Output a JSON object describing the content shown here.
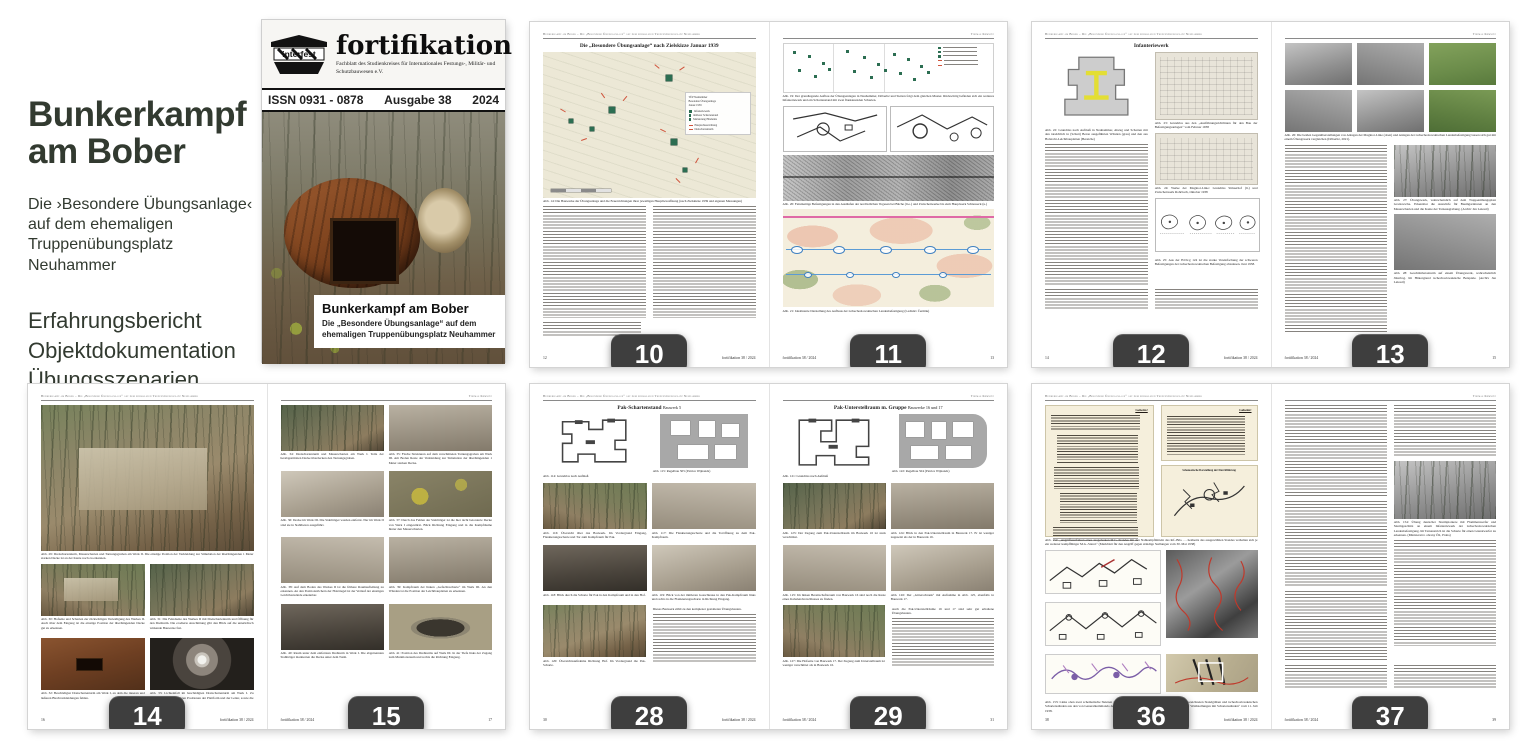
{
  "colors": {
    "badge_bg": "#3e3e3e",
    "badge_text": "#ffffff",
    "sidebar_text": "#323a30",
    "map_green": "#2c6e52",
    "map_red": "#d0543c"
  },
  "sidebar": {
    "title_line1": "Bunkerkampf",
    "title_line2": "am Bober",
    "subtitle": "Die ›Besondere Übungsanlage‹ auf dem ehemaligen Truppenübungsplatz Neuhammer",
    "features": [
      "Erfahrungsbericht",
      "Objektdokumentation",
      "Übungsszenarien"
    ],
    "link": "vimudeap.info/bkab"
  },
  "cover": {
    "logo_text": "interfest",
    "magazine_title": "fortifikation",
    "magazine_subtitle": "Fachblatt des Studienkreises für Internationales Festungs-, Militär- und Schutzbauwesen e.V.",
    "issn": "ISSN 0931 - 0878",
    "issue": "Ausgabe 38",
    "year": "2024",
    "cover_title": "Bunkerkampf am Bober",
    "cover_subtitle": "Die „Besondere Übungsanlage“ auf dem ehemaligen Truppen­übungsplatz Neuhammer"
  },
  "common": {
    "running_header": "Bunkerkampf am Bober – Die „Besondere Übungsanlage“ auf dem ehemaligen Truppenübungsplatz Neuhammer",
    "author": "Thomas Kemnitz",
    "journal_footer": "fortifikation 38 / 2024"
  },
  "pages": {
    "p10": {
      "badge": "10",
      "folio": "12",
      "title": "Die „Besondere Übungsanlage“ nach Zielskizze Januar 1939",
      "map_legend": {
        "line1": "TÜP Neuhammer",
        "line2": "Besondere Übungsanlage",
        "line3": "Januar 1939",
        "items": [
          "Infanteriewerk",
          "mittlerer Schartenstand",
          "Markierung Hindernis"
        ],
        "items_red": [
          "Hauptschussrichtung",
          "Dreischartenturm"
        ]
      },
      "captions": [
        "Abb. 14: Die Bauwerke der Übungsanlage und die Feuerrichtungen ihrer jeweiligen Hauptbewaffnung (nach Zielskizze 1939 und eigenen Messungen)"
      ]
    },
    "p11": {
      "badge": "11",
      "folio": "13",
      "captions": [
        "Abb. 19: Der grundlegende Aufbau der Übungsanlagen in Neuhammer, Döberitz und Stetten folgt dem gleichen Muster. Rückwärtig befinden sich ein weiteres Infanteriewerk und ein Schartenstand mit zwei flankierenden Scharten.",
        "Abb. 20: Feindseitige Befestigungen in den Ausläufen der nordöstlichen Vogesen bei Bitche (li.o.) und Zwischenwerke bis zum Hauptwerk Schiesseck (u.)",
        "Abb. 21: Idealisierte Darstellung des Aufbaus der tschechoslowakischen Landesbefestigung (Ladislav Čermák)"
      ]
    },
    "p12": {
      "badge": "12",
      "folio": "14",
      "heading": "Infanteriewerk",
      "captions": [
        "Abb. 22: Grundriss nach Aufmaß in Neuhammer, Abzug und Scharten mit den tatsächlich in (Schutt) Beton ausgeführten Wänden (grau) und den aus Holzrohr-Leichtbauplatten (Bereiche)",
        "Abb. 23: Grundriss aus den „Ausführungsrichtlinien für den Bau der Befestigungsanlagen“ vom Februar 1938",
        "Abb. 24: Werke der Maginot-Linie: Grundriss Simserhof (li.) und Zwischenwerk Rohrbach, Oktober 1938",
        "Abb. 25: Aus der H.Dv.g 124 ist die starke Vereinfachung der schweren Befestigungen der tschechoslowakischen Befestigung abzulesen. Juni 1938."
      ]
    },
    "p13": {
      "badge": "13",
      "folio": "15",
      "captions": [
        "Abb. 26: Die beiden Gegenüberstellungen von Anlagen der Maginot-Linie (oben) und Anlagen der tschechoslowakischen Landesbefestigung lassen sich gut mit einem Übungswerk vergleichen (Döberitz, 2021).",
        "Abb. 27: Übungswerk, wahrscheinlich auf dem Truppenübungsplatz Gradowsche. Erkennbar die Auswürfe für Baumgarnituren an den Mauerscharten und die Kante der Tarnausgrabung. (Archiv Jan Lakosil)",
        "Abb. 28: Geschützbetonturm auf einem Übungswerk, wahrscheinlich Jüterbog. Im Hintergrund tschechoslowakische Beispiele. (Archiv Jan Lakosil)"
      ]
    },
    "p14": {
      "badge": "14",
      "folio": "16",
      "captions": [
        "Abb. 29: Dreischartenturm, Mauerscharten und Tarnungsgruben am Werk II. Die einstige Position der Verkleidung zur Simulation der überhängenden 1 Meter starken Decke ist an der Kante noch zu erkennen.",
        "Abb. 30: Hofseite und Scharten zur rückwärtigen Verteidigung des Werkes II. Auch über dem Eingang ist die einstige Position der überhängenden Decke gut zu erkennen.",
        "Abb. 31: Die Feindseite des Werkes II mit Dreischartenturm und Öffnung für den Drehturm. Die erodierte Anschüttung gibt den Blick auf die unterirdisch wirkende Bauweise frei.",
        "Abb. 32: Beschädigter Dreischartenturm am Werk I, an dem die inneren und äußeren Blechverkleidungen fehlen.",
        "Abb. 33: Lichteinfall im beschädigten Dreischartenturm am Werk I. Zu erkennen sind die einstigen Positionen der Plattform und der Leiter, sowie die Auflage des Turmes."
      ]
    },
    "p15": {
      "badge": "15",
      "folio": "17",
      "captions": [
        "Abb. 34: Dreischartenturm und Mauerscharten am Werk I. Teile der herabgestürzten Decke überdecken den Tarnungsgraben.",
        "Abb. 35: Flache Strukturen auf dem verschütteten Tarnungsgraben am Werk III. Am Boden Reste der Verkleidung zur Simulation der überhängenden 1 Meter starken Decke.",
        "Abb. 36: Decke im Werk III. Die Stahlträger wurden entfernt. Nur im Werk II sind sie in Stahlbeton ausgeführt.",
        "Abb. 37: Durch das Fehlen der Stahlträger ist die hier nicht betonierte Decke von Werk I eingestürzt. Blick Richtung Eingang und in die Kampfräume hinter den Mauerscharten.",
        "Abb. 38: Auf dem Boden des Werkes II ist die frühere Raumaufteilung zu erkennen. An den Positionslöchern der Holzriegel ist der Verlauf der einstigen Leichtbauwände erkennbar.",
        "Abb. 39: Kampfraum der linken „Gefechtsscharte“ im Werk III. An den Wänden ist die Position der Leichtbauplatten zu erkennen.",
        "Abb. 40: Raum unter dem entfernten Drehturm in Werk I. Die abgetrennten Stahlträger markierten die Decke unter dem Turm.",
        "Abb. 41: Position des Drehturms auf Werk III. In der Tiefe links der Zugang zum Munitionsraum und rechts die Richtung Eingang."
      ]
    },
    "p28": {
      "badge": "28",
      "folio": "30",
      "heading": "Pak-Schartenstand",
      "heading_sub": "Bauwerk 5",
      "captions": [
        "Abb. 114: Grundriss nach Aufmaß",
        "Abb. 115: Regelbau 505 (Patrice Wijnands)",
        "Abb. 116: Übersicht über das Bauwerk. Im Vordergrund Eingang, Flankierungsscharte und Tor zum Kampfraum für Pak.",
        "Abb. 117: Die Flankierungsscharte und die Toröffnung zu dem Pak-Kampfraum.",
        "Abb. 118: Blick durch die Scharte für Pak in den Kampfraum und in den Hof.",
        "Abb. 119: Blick von der mittleren Gasschleuse in den Pak-Kampfraum links und rechts in die Flankierungsscharte in Richtung Eingang.",
        "Abb. 120: Übersichtsaufnahme Richtung Hof. Im Vordergrund die Pak-Scharte."
      ],
      "body_start": "Dieses Bauwerk zählt zu den komplexer gestalteten Übungsbauten."
    },
    "p29": {
      "badge": "29",
      "folio": "31",
      "heading": "Pak-Unterstellraum m. Gruppe",
      "heading_sub": "Bauwerke 16 und 17",
      "captions": [
        "Abb. 121: Grundriss nach Aufmaß",
        "Abb. 122: Regelbau 504 (Patrice Wijnands)",
        "Abb. 123: Der Zugang zum Pak-Unterstellraum im Bauwerk 16 ist stark verschüttet.",
        "Abb. 124: Blick in den Pak-Unterstellraum in Bauwerk 17. Er ist weniger zugesetzt als der in Bauwerk 16.",
        "Abb. 125: Im linken Bereitschaftsraum von Bauwerk 16 sind noch die Reste eines Kabelendverschlusses zu finden.",
        "Abb. 126: Der „Gitterschrank“ mit Aufnahme in Abb. 125, ebenfalls in Bauwerk 17.",
        "Abb. 127: Die Hofseite von Bauwerk 17. Der Zugang zum Unterstellraum ist weniger verschüttet als in Bauwerk 16."
      ],
      "body_start": "Auch die Pak-Unterstellräume 16 und 17 sind sehr gut erhaltene Übungsbauten."
    },
    "p36": {
      "badge": "36",
      "folio": "38",
      "doc_label": "Geheim!",
      "schematic_title": "Schematische Darstellung der Durchführung",
      "captions": [
        "Abb. 152: „Angriffsverfahren eines ausgebauten M.G.-Standes mit den Nahkampfmitteln des Inf.-Btls. … heidseits des ausgewählten Standes verhalten sich je ein weiterer kampffähiger M.G.-Stand.“ (Merkblatt für den Angriff gegen ständige Stellungen vom 30. Mai 1938)",
        "Abb. 153: Links oben zwei schematische Skizzen und rechts oben das dazugehörige Luftbild mit rot eingezeichneten Standgräben und tschechoslowakischen Schartenständen aus den von Generalkommando des IV. Armeekorps erarbeiteten Anweisungen „Angriff auf Waldstellungen mit Schartenständen“ vom 11. Juli 1938."
      ]
    },
    "p37": {
      "badge": "37",
      "folio": "39",
      "captions": [
        "Abb. 154: Übung deutscher Sturmpioniere mit Flammenwerfer und Sturmgeschütz an einem Infanteriewerk der tschechoslowakischen Landesbefestigung. Im Tarnanstrich ist die Scharte für einen Granatwerfer zu erkennen. (Ministerstvo obrany ČR, Praha)"
      ]
    }
  }
}
